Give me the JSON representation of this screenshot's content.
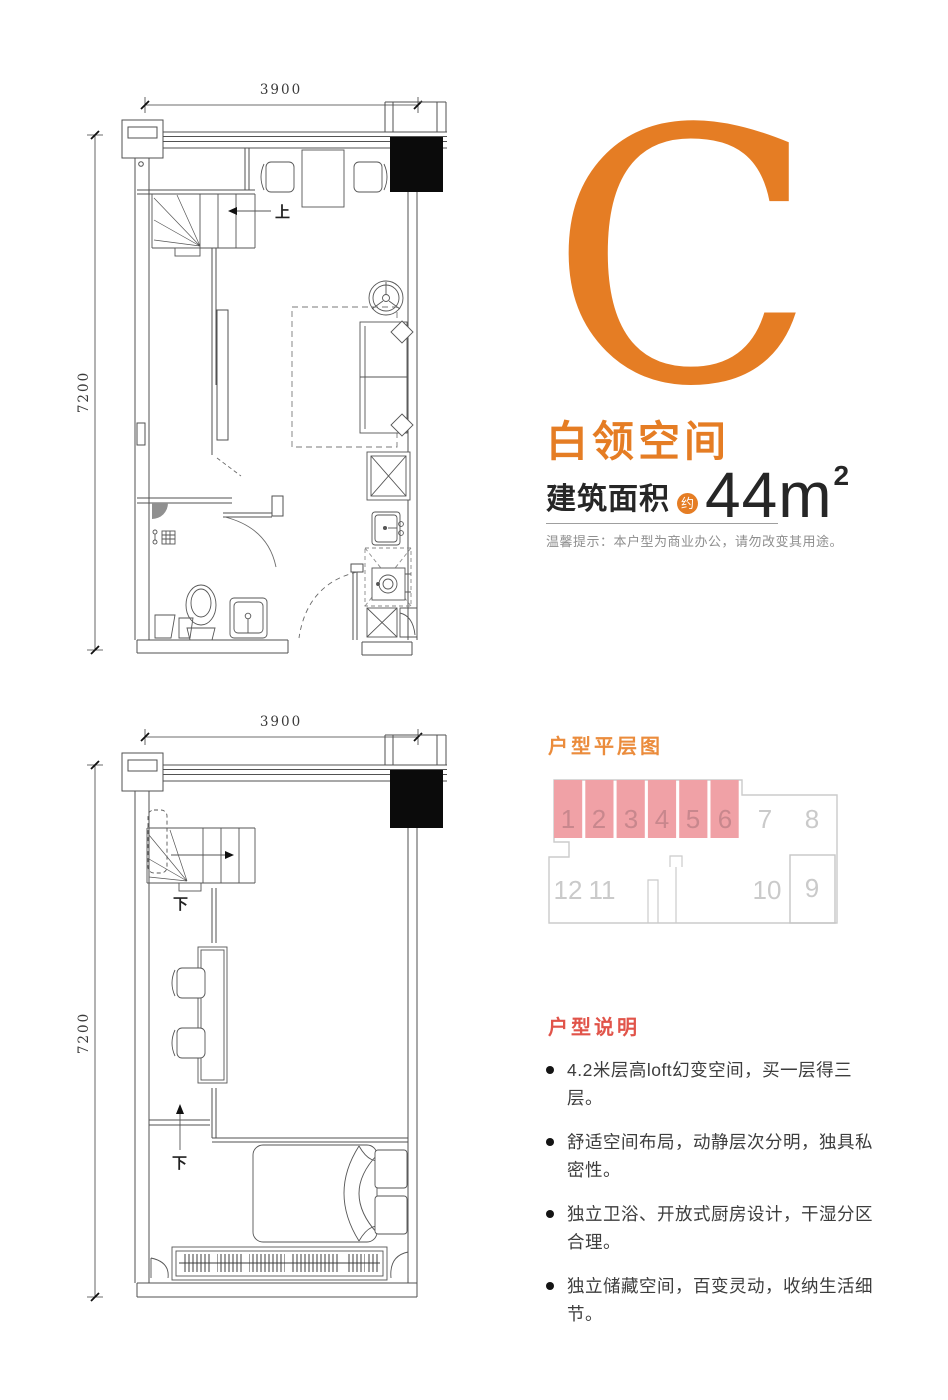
{
  "unit_card": {
    "letter": "C",
    "name": "白领空间",
    "area_label": "建筑面积",
    "area_approx_badge": "约",
    "area_value": "44",
    "area_unit": "m",
    "area_superscript": "2",
    "notice": "温馨提示：本户型为商业办公，请勿改变其用途。"
  },
  "plans": {
    "upper": {
      "width_dim": "3900",
      "height_dim": "7200",
      "stair_label": "上"
    },
    "lower": {
      "width_dim": "3900",
      "height_dim": "7200",
      "stair_label_1": "下",
      "stair_label_2": "下"
    }
  },
  "floor_plate": {
    "title": "户型平层图",
    "units": [
      {
        "label": "1",
        "highlighted": true
      },
      {
        "label": "2",
        "highlighted": true
      },
      {
        "label": "3",
        "highlighted": true
      },
      {
        "label": "4",
        "highlighted": true
      },
      {
        "label": "5",
        "highlighted": true
      },
      {
        "label": "6",
        "highlighted": true
      },
      {
        "label": "7",
        "highlighted": false
      },
      {
        "label": "8",
        "highlighted": false
      },
      {
        "label": "9",
        "highlighted": false
      },
      {
        "label": "10",
        "highlighted": false
      },
      {
        "label": "11",
        "highlighted": false
      },
      {
        "label": "12",
        "highlighted": false
      }
    ]
  },
  "description": {
    "title": "户型说明",
    "bullets": [
      "4.2米层高loft幻变空间，买一层得三层。",
      "舒适空间布局，动静层次分明，独具私密性。",
      "独立卫浴、开放式厨房设计，干湿分区合理。",
      "独立储藏空间，百变灵动，收纳生活细节。"
    ]
  },
  "colors": {
    "accent_orange": "#E57D24",
    "plate_title_orange": "#EB8C3C",
    "desc_title_red": "#E1544A",
    "plate_pink": "#F0A1A6",
    "plate_pink_number": "#C8878D",
    "plate_gray": "#CBCBCB"
  }
}
